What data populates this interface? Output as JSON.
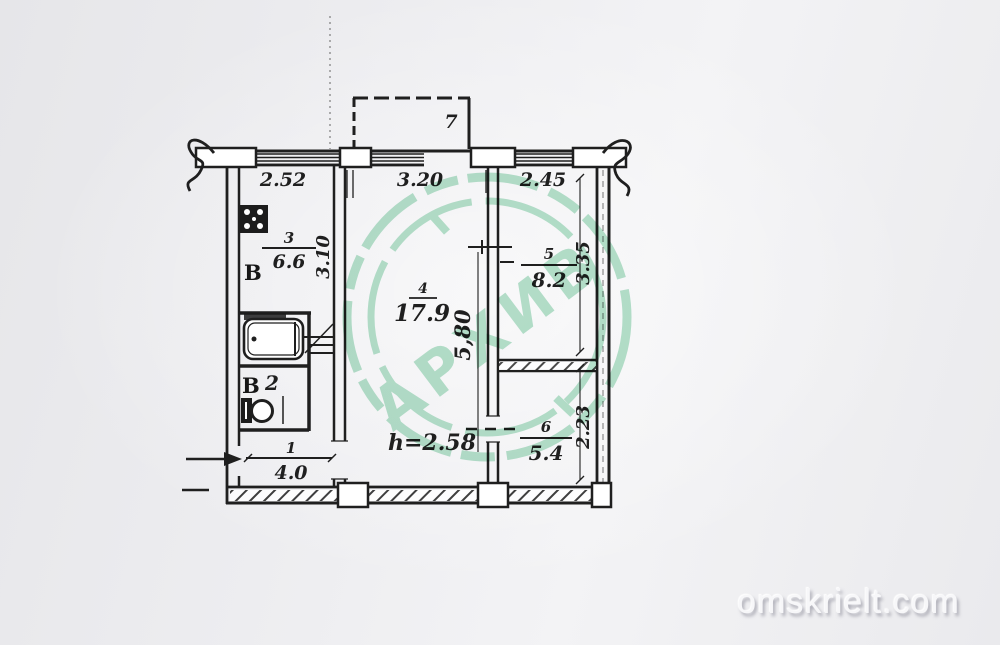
{
  "page": {
    "watermark": "omskrielt.com"
  },
  "stamp": {
    "text": "АРХИВ",
    "color": "#a5dcc0"
  },
  "plan": {
    "ink": "#1f1f1f",
    "balcony": {
      "label": "7"
    },
    "top_dims": {
      "left": "2.52",
      "middle": "3.20",
      "right": "2.45"
    },
    "side_dims": {
      "kitchen": "3.10",
      "living": "5,80",
      "room5": "3.35",
      "room6": "2.23"
    },
    "ceiling_height": "h=2.58",
    "rooms": {
      "kitchen": {
        "number": "3",
        "area": "6.6",
        "vent": "В"
      },
      "living": {
        "number": "4",
        "area": "17.9"
      },
      "room5": {
        "number": "5",
        "area": "8.2"
      },
      "room6": {
        "number": "6",
        "area": "5.4"
      },
      "hall": {
        "number": "1",
        "area": "4.0"
      },
      "wc": {
        "number": "2",
        "vent": "В"
      }
    }
  }
}
